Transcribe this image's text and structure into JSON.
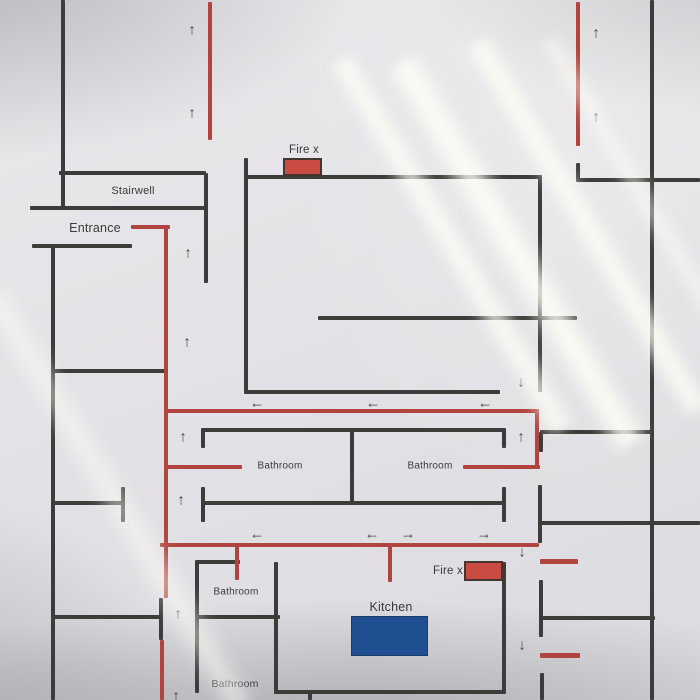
{
  "palette": {
    "wall": "#3e3c3a",
    "route": "#b2443f",
    "fire_box_fill": "#c94b41",
    "fire_box_border": "#46352e",
    "kitchen_box_fill": "#1f4f90",
    "paper": "#e3e2e6",
    "ink": "#3a3a3c"
  },
  "plan": {
    "labels": [
      {
        "name": "stairwell-label",
        "text": "Stairwell",
        "x": 133,
        "y": 191,
        "size": 11
      },
      {
        "name": "entrance-label",
        "text": "Entrance",
        "x": 95,
        "y": 228,
        "size": 12.5
      },
      {
        "name": "fire-ext-top-label",
        "text": "Fire x",
        "x": 304,
        "y": 150,
        "size": 11.5
      },
      {
        "name": "fire-ext-bottom-label",
        "text": "Fire x",
        "x": 448,
        "y": 571,
        "size": 11.5
      },
      {
        "name": "bathroom-mid-left-label",
        "text": "Bathroom",
        "x": 280,
        "y": 466,
        "size": 10
      },
      {
        "name": "bathroom-mid-right-label",
        "text": "Bathroom",
        "x": 430,
        "y": 466,
        "size": 10
      },
      {
        "name": "bathroom-lower-label",
        "text": "Bathroom",
        "x": 236,
        "y": 592,
        "size": 10
      },
      {
        "name": "bathroom-bottom-label",
        "text": "Bathroom",
        "x": 235,
        "y": 684,
        "size": 10.5
      },
      {
        "name": "kitchen-label",
        "text": "Kitchen",
        "x": 391,
        "y": 607,
        "size": 12.5
      }
    ],
    "walls": [
      {
        "x": 61,
        "y": 0,
        "w": 4,
        "h": 208
      },
      {
        "x": 51,
        "y": 246,
        "w": 4,
        "h": 454
      },
      {
        "x": 204,
        "y": 173,
        "w": 4,
        "h": 110
      },
      {
        "x": 244,
        "y": 158,
        "w": 4,
        "h": 234
      },
      {
        "x": 538,
        "y": 177,
        "w": 4,
        "h": 215
      },
      {
        "x": 650,
        "y": 0,
        "w": 4,
        "h": 700
      },
      {
        "x": 576,
        "y": 163,
        "w": 4,
        "h": 18
      },
      {
        "x": 350,
        "y": 430,
        "w": 4,
        "h": 73
      },
      {
        "x": 201,
        "y": 430,
        "w": 4,
        "h": 18
      },
      {
        "x": 201,
        "y": 487,
        "w": 4,
        "h": 35
      },
      {
        "x": 502,
        "y": 430,
        "w": 4,
        "h": 18
      },
      {
        "x": 502,
        "y": 487,
        "w": 4,
        "h": 35
      },
      {
        "x": 121,
        "y": 487,
        "w": 4,
        "h": 35
      },
      {
        "x": 539,
        "y": 432,
        "w": 4,
        "h": 20
      },
      {
        "x": 538,
        "y": 485,
        "w": 4,
        "h": 58
      },
      {
        "x": 539,
        "y": 580,
        "w": 4,
        "h": 57
      },
      {
        "x": 540,
        "y": 673,
        "w": 4,
        "h": 27
      },
      {
        "x": 502,
        "y": 562,
        "w": 4,
        "h": 130
      },
      {
        "x": 195,
        "y": 562,
        "w": 4,
        "h": 131
      },
      {
        "x": 274,
        "y": 562,
        "w": 4,
        "h": 130
      },
      {
        "x": 308,
        "y": 692,
        "w": 4,
        "h": 8
      },
      {
        "x": 159,
        "y": 598,
        "w": 4,
        "h": 42
      },
      {
        "x": 59,
        "y": 171,
        "w": 147,
        "h": 4
      },
      {
        "x": 30,
        "y": 206,
        "w": 176,
        "h": 4
      },
      {
        "x": 32,
        "y": 244,
        "w": 100,
        "h": 4
      },
      {
        "x": 244,
        "y": 175,
        "w": 298,
        "h": 4
      },
      {
        "x": 576,
        "y": 178,
        "w": 124,
        "h": 4
      },
      {
        "x": 318,
        "y": 316,
        "w": 259,
        "h": 4
      },
      {
        "x": 244,
        "y": 390,
        "w": 256,
        "h": 4
      },
      {
        "x": 51,
        "y": 369,
        "w": 117,
        "h": 4
      },
      {
        "x": 201,
        "y": 428,
        "w": 305,
        "h": 4
      },
      {
        "x": 540,
        "y": 430,
        "w": 112,
        "h": 4
      },
      {
        "x": 51,
        "y": 501,
        "w": 74,
        "h": 4
      },
      {
        "x": 201,
        "y": 501,
        "w": 305,
        "h": 4
      },
      {
        "x": 540,
        "y": 521,
        "w": 160,
        "h": 4
      },
      {
        "x": 195,
        "y": 560,
        "w": 45,
        "h": 4
      },
      {
        "x": 53,
        "y": 615,
        "w": 108,
        "h": 4
      },
      {
        "x": 195,
        "y": 615,
        "w": 85,
        "h": 4
      },
      {
        "x": 540,
        "y": 616,
        "w": 115,
        "h": 4
      },
      {
        "x": 274,
        "y": 690,
        "w": 232,
        "h": 4
      }
    ],
    "routes": [
      {
        "x": 208,
        "y": 2,
        "w": 4,
        "h": 138
      },
      {
        "x": 576,
        "y": 2,
        "w": 4,
        "h": 144
      },
      {
        "x": 131,
        "y": 225,
        "w": 39,
        "h": 4
      },
      {
        "x": 164,
        "y": 225,
        "w": 4,
        "h": 373
      },
      {
        "x": 160,
        "y": 640,
        "w": 4,
        "h": 60
      },
      {
        "x": 164,
        "y": 409,
        "w": 375,
        "h": 4
      },
      {
        "x": 535,
        "y": 409,
        "w": 4,
        "h": 60
      },
      {
        "x": 164,
        "y": 465,
        "w": 78,
        "h": 4
      },
      {
        "x": 463,
        "y": 465,
        "w": 77,
        "h": 4
      },
      {
        "x": 160,
        "y": 543,
        "w": 379,
        "h": 4
      },
      {
        "x": 235,
        "y": 543,
        "w": 4,
        "h": 37
      },
      {
        "x": 388,
        "y": 543,
        "w": 4,
        "h": 39
      },
      {
        "x": 540,
        "y": 559,
        "w": 38,
        "h": 5
      },
      {
        "x": 540,
        "y": 653,
        "w": 40,
        "h": 5
      }
    ],
    "boxes": [
      {
        "name": "fire-extinguisher-marker-top",
        "kind": "fire",
        "x": 283,
        "y": 158,
        "w": 39,
        "h": 18
      },
      {
        "name": "fire-extinguisher-marker-bottom",
        "kind": "fire",
        "x": 464,
        "y": 561,
        "w": 39,
        "h": 20
      },
      {
        "name": "kitchen-island-marker",
        "kind": "kitchen",
        "x": 351,
        "y": 616,
        "w": 77,
        "h": 40
      }
    ],
    "arrows": [
      {
        "dir": "up",
        "symbol": "↑",
        "x": 192,
        "y": 30
      },
      {
        "dir": "up",
        "symbol": "↑",
        "x": 192,
        "y": 113
      },
      {
        "dir": "up",
        "symbol": "↑",
        "x": 596,
        "y": 33
      },
      {
        "dir": "up",
        "symbol": "↑",
        "x": 596,
        "y": 117
      },
      {
        "dir": "up",
        "symbol": "↑",
        "x": 188,
        "y": 253
      },
      {
        "dir": "up",
        "symbol": "↑",
        "x": 187,
        "y": 342
      },
      {
        "dir": "up",
        "symbol": "↑",
        "x": 183,
        "y": 437
      },
      {
        "dir": "up",
        "symbol": "↑",
        "x": 521,
        "y": 437
      },
      {
        "dir": "up",
        "symbol": "↑",
        "x": 181,
        "y": 500
      },
      {
        "dir": "up",
        "symbol": "↑",
        "x": 178,
        "y": 614
      },
      {
        "dir": "up",
        "symbol": "↑",
        "x": 176,
        "y": 696
      },
      {
        "dir": "down",
        "symbol": "↓",
        "x": 521,
        "y": 382
      },
      {
        "dir": "down",
        "symbol": "↓",
        "x": 522,
        "y": 552
      },
      {
        "dir": "down",
        "symbol": "↓",
        "x": 522,
        "y": 645
      },
      {
        "dir": "left",
        "symbol": "←",
        "x": 257,
        "y": 403
      },
      {
        "dir": "left",
        "symbol": "←",
        "x": 373,
        "y": 403
      },
      {
        "dir": "left",
        "symbol": "←",
        "x": 485,
        "y": 403
      },
      {
        "dir": "left",
        "symbol": "←",
        "x": 257,
        "y": 534
      },
      {
        "dir": "left",
        "symbol": "←",
        "x": 372,
        "y": 534
      },
      {
        "dir": "right",
        "symbol": "→",
        "x": 408,
        "y": 534
      },
      {
        "dir": "right",
        "symbol": "→",
        "x": 484,
        "y": 534
      }
    ]
  }
}
